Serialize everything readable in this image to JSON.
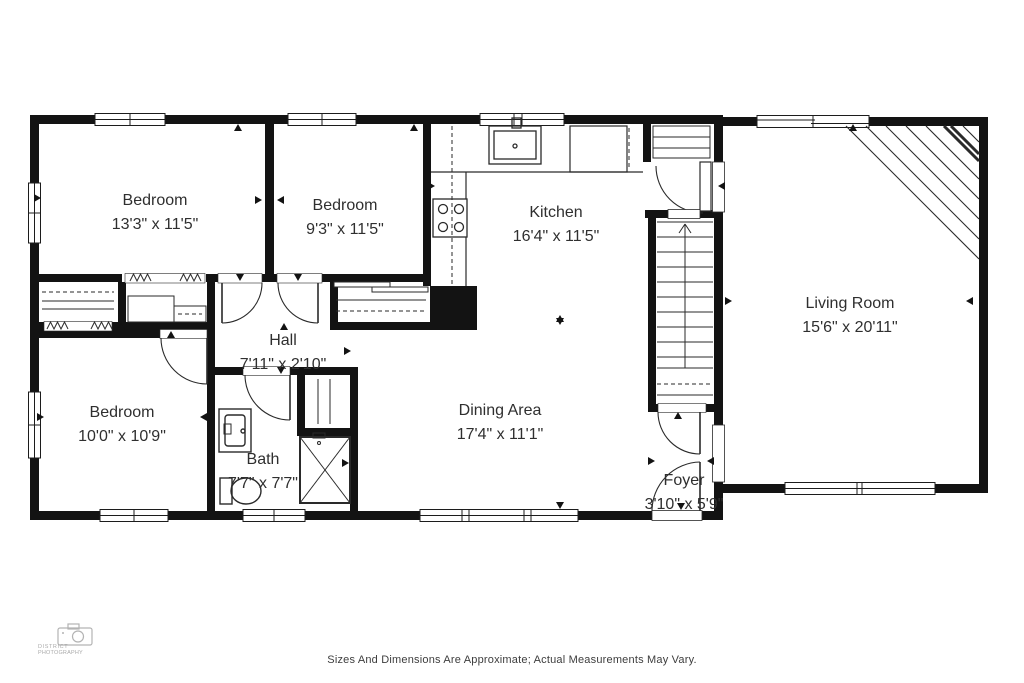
{
  "page": {
    "background": "#ffffff",
    "wall_color": "#131313",
    "label_color": "#2f2f2f"
  },
  "rooms": [
    {
      "id": "bedroom-front",
      "name": "Bedroom",
      "dims": "13'3\" x 11'5\""
    },
    {
      "id": "bedroom-middle",
      "name": "Bedroom",
      "dims": "9'3\" x 11'5\""
    },
    {
      "id": "kitchen",
      "name": "Kitchen",
      "dims": "16'4\" x 11'5\""
    },
    {
      "id": "living-room",
      "name": "Living Room",
      "dims": "15'6\" x 20'11\""
    },
    {
      "id": "hall",
      "name": "Hall",
      "dims": "7'11\" x 2'10\""
    },
    {
      "id": "bedroom-rear",
      "name": "Bedroom",
      "dims": "10'0\" x 10'9\""
    },
    {
      "id": "bath",
      "name": "Bath",
      "dims": "7'7\" x 7'7\""
    },
    {
      "id": "dining-area",
      "name": "Dining Area",
      "dims": "17'4\" x 11'1\""
    },
    {
      "id": "foyer",
      "name": "Foyer",
      "dims": "3'10\" x 5'9\""
    }
  ],
  "fixture_icons": [
    "kitchen-sink-icon",
    "stove-icon",
    "refrigerator-icon",
    "vanity-sink-icon",
    "toilet-icon",
    "shower-icon",
    "stairs-up-icon",
    "closet-shelves-icon",
    "window-symbol",
    "door-swing-symbol",
    "camera-icon"
  ],
  "footer": {
    "disclaimer": "Sizes And Dimensions Are Approximate; Actual Measurements May Vary."
  },
  "watermark": {
    "line1": "DISTRICT",
    "line2": "PHOTOGRAPHY"
  }
}
